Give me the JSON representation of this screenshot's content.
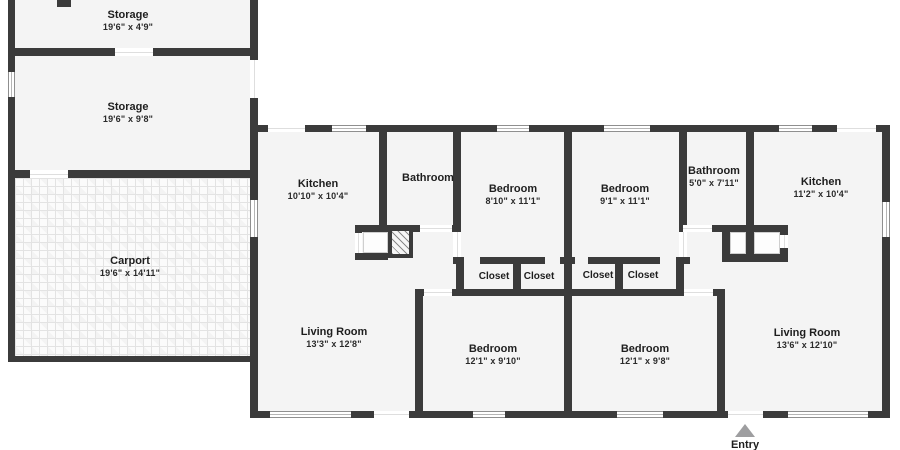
{
  "floor_plan": {
    "rooms": [
      {
        "id": "storage-1",
        "name": "Storage",
        "dims": "19'6\" x 4'9\""
      },
      {
        "id": "storage-2",
        "name": "Storage",
        "dims": "19'6\" x 9'8\""
      },
      {
        "id": "carport",
        "name": "Carport",
        "dims": "19'6\" x 14'11\""
      },
      {
        "id": "kitchen-left",
        "name": "Kitchen",
        "dims": "10'10\" x 10'4\""
      },
      {
        "id": "bathroom-left",
        "name": "Bathroom"
      },
      {
        "id": "bedroom-top-left",
        "name": "Bedroom",
        "dims": "8'10\" x 11'1\""
      },
      {
        "id": "bedroom-top-right",
        "name": "Bedroom",
        "dims": "9'1\" x 11'1\""
      },
      {
        "id": "bathroom-right",
        "name": "Bathroom",
        "dims": "5'0\" x 7'11\""
      },
      {
        "id": "kitchen-right",
        "name": "Kitchen",
        "dims": "11'2\" x 10'4\""
      },
      {
        "id": "living-room-left",
        "name": "Living Room",
        "dims": "13'3\" x 12'8\""
      },
      {
        "id": "bedroom-bottom-left",
        "name": "Bedroom",
        "dims": "12'1\" x 9'10\""
      },
      {
        "id": "bedroom-bottom-right",
        "name": "Bedroom",
        "dims": "12'1\" x 9'8\""
      },
      {
        "id": "living-room-right",
        "name": "Living Room",
        "dims": "13'6\" x 12'10\""
      }
    ],
    "closets": [
      "Closet",
      "Closet",
      "Closet",
      "Closet"
    ],
    "entry": {
      "label": "Entry",
      "marker": "triangle-up"
    },
    "colors": {
      "wall": "#3b3b3b",
      "room_fill": "#f4f4f4",
      "background": "#ffffff",
      "entry_marker": "#9e9ea0",
      "water_heater_hatch": "#8a8a8a"
    }
  }
}
